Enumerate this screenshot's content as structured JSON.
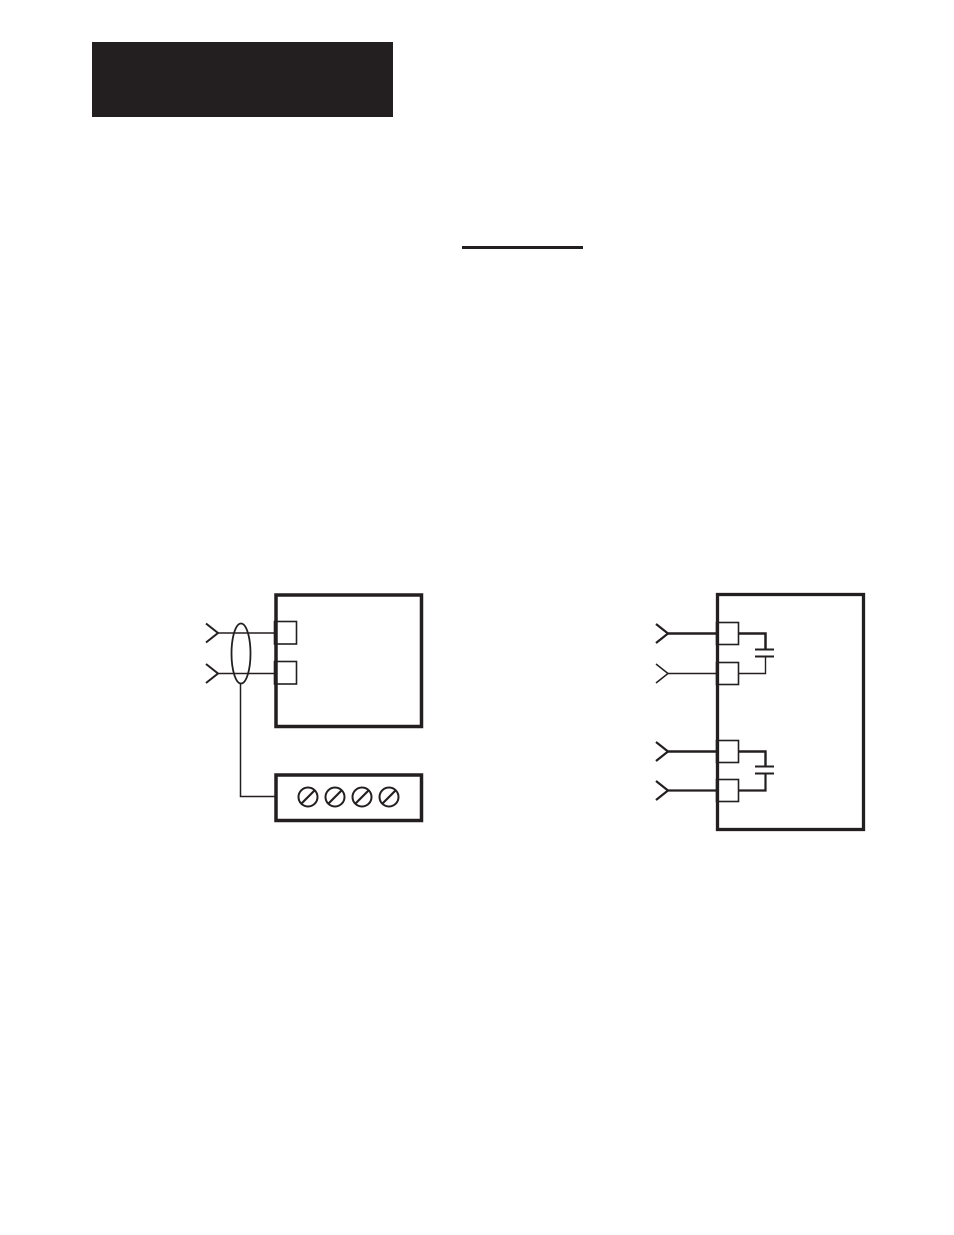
{
  "page": {
    "kind": "scanned-manual-page",
    "background": "#ffffff",
    "ink": "#231f20"
  },
  "header": {
    "title_block_color": "#231f20"
  },
  "rule_line": {
    "color": "#231f20"
  },
  "figures": {
    "shielded_input_wiring": {
      "description_name": "shielded-twisted-pair-input-with-ground-bar",
      "input_arrow_count": 2,
      "input_terminal_count": 2,
      "shield_symbol": "cable-shield-ellipse",
      "ground_bar_screw_count": 4
    },
    "capacitor_input_wiring": {
      "description_name": "module-inputs-with-internal-filter-capacitors",
      "input_arrow_count": 4,
      "input_terminal_count": 4,
      "capacitor_count": 2
    }
  }
}
